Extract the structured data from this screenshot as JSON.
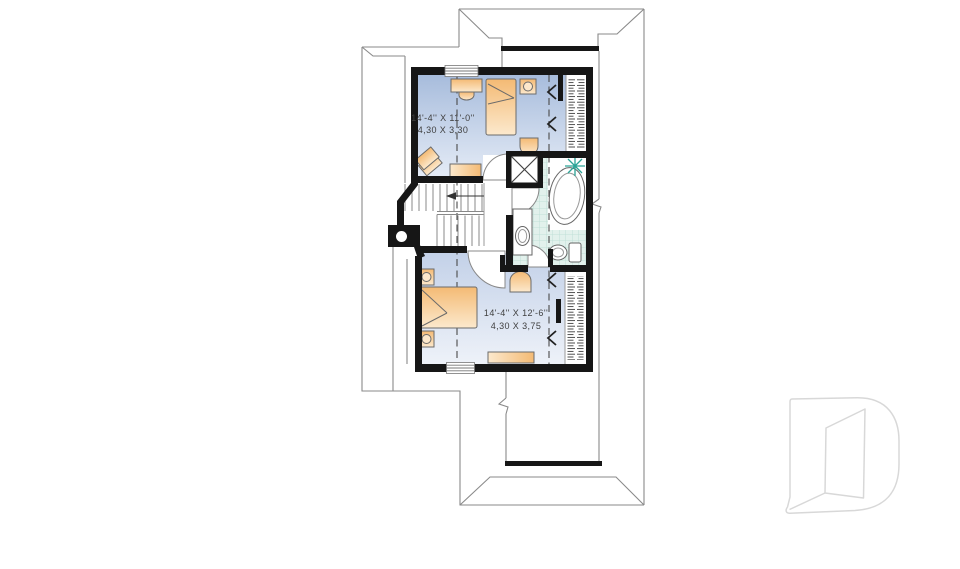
{
  "plan": {
    "type": "second-floor-plan",
    "rooms": [
      {
        "id": "bedroom-1",
        "dimension_imperial": "14'-4'' X 11'-0''",
        "dimension_metric": "4,30 X 3,30"
      },
      {
        "id": "bedroom-2",
        "dimension_imperial": "14'-4'' X 12'-6''",
        "dimension_metric": "4,30 X 3,75"
      }
    ]
  },
  "labels": {
    "bedroom1_imperial": "14'-4'' X 11'-0''",
    "bedroom1_metric": "4,30 X 3,30",
    "bedroom2_imperial": "14'-4'' X 12'-6''",
    "bedroom2_metric": "4,30 X 3,75"
  },
  "icons": {
    "plant": "starburst-plant-icon",
    "logo": "drummond-d-logo"
  },
  "colors": {
    "wall": "#161616",
    "roofline": "#8a8a8a",
    "floor1_top": "#a7bcdc",
    "floor1_bottom": "#e4ebf6",
    "floor2_top": "#c3d1e8",
    "floor2_bottom": "#eef2f9",
    "furniture_dark": "#f4ba74",
    "furniture_light": "#fce9cd",
    "tile": "#e2f1ec",
    "tile_grid": "#b8dcd2",
    "plant_teal": "#2aa396",
    "logo_gray": "#d8d8d8"
  }
}
